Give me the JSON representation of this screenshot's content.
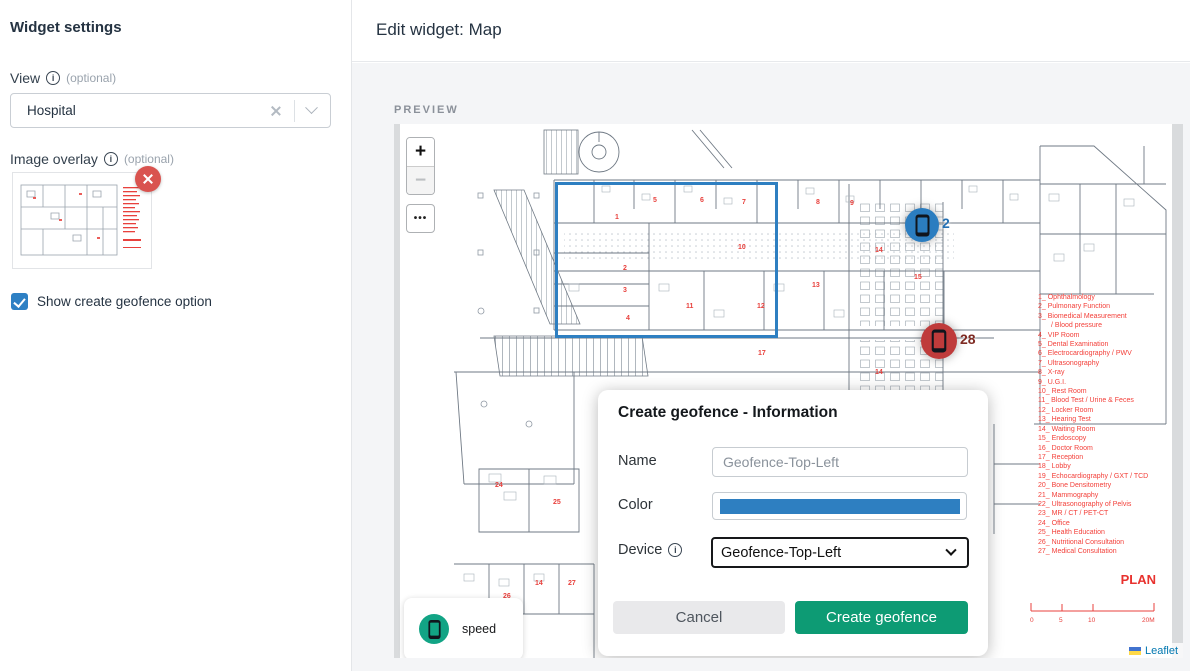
{
  "sidebar": {
    "title": "Widget settings",
    "view_label": "View",
    "view_optional": "(optional)",
    "view_value": "Hospital",
    "overlay_label": "Image overlay",
    "overlay_optional": "(optional)",
    "checkbox_label": "Show create geofence option"
  },
  "header": {
    "title": "Edit widget: Map"
  },
  "preview": {
    "label": "PREVIEW"
  },
  "map": {
    "controls": {
      "zoom_in": "+",
      "zoom_out": "−",
      "more": "•••"
    },
    "markers": [
      {
        "id": "blue",
        "count": "2",
        "color": "#2b7dc0",
        "label_color": "#2470b3"
      },
      {
        "id": "red",
        "count": "28",
        "color": "#bf3b3b",
        "label_color": "#7e2a22"
      }
    ],
    "speed_legend": "speed",
    "legend_title": "PLAN",
    "legend_items": [
      "1_ Ophthalmology",
      "2_ Pulmonary Function",
      "3_ Biomedical Measurement",
      "/ Blood pressure",
      "4_ VIP Room",
      "5_ Dental Examination",
      "6_ Electrocardiography / PWV",
      "7_ Ultrasonography",
      "8_ X-ray",
      "9_ U.G.I.",
      "10_ Rest Room",
      "11_ Blood Test / Urine & Feces",
      "12_ Locker Room",
      "13_ Hearing Test",
      "14_ Waiting Room",
      "15_ Endoscopy",
      "16_ Doctor Room",
      "17_ Reception",
      "18_ Lobby",
      "19_ Echocardiography / GXT / TCD",
      "20_ Bone Densitometry",
      "21_ Mammography",
      "22_ Ultrasonography of Pelvis",
      "23_ MR / CT / PET-CT",
      "24_ Office",
      "25_ Health Education",
      "26_ Nutritional Consultation",
      "27_ Medical Consultation"
    ],
    "scale": {
      "ticks": [
        "0",
        "5",
        "10",
        "20M"
      ]
    },
    "attribution": "Leaflet",
    "plan_numbers": [
      {
        "x": 221,
        "y": 95,
        "t": "1"
      },
      {
        "x": 229,
        "y": 146,
        "t": "2"
      },
      {
        "x": 229,
        "y": 168,
        "t": "3"
      },
      {
        "x": 232,
        "y": 196,
        "t": "4"
      },
      {
        "x": 259,
        "y": 78,
        "t": "5"
      },
      {
        "x": 306,
        "y": 78,
        "t": "6"
      },
      {
        "x": 348,
        "y": 80,
        "t": "7"
      },
      {
        "x": 422,
        "y": 80,
        "t": "8"
      },
      {
        "x": 456,
        "y": 81,
        "t": "9"
      },
      {
        "x": 344,
        "y": 125,
        "t": "10"
      },
      {
        "x": 292,
        "y": 184,
        "t": "11"
      },
      {
        "x": 363,
        "y": 184,
        "t": "12"
      },
      {
        "x": 418,
        "y": 163,
        "t": "13"
      },
      {
        "x": 481,
        "y": 128,
        "t": "14"
      },
      {
        "x": 520,
        "y": 155,
        "t": "15"
      },
      {
        "x": 481,
        "y": 250,
        "t": "14"
      },
      {
        "x": 364,
        "y": 231,
        "t": "17"
      },
      {
        "x": 101,
        "y": 363,
        "t": "24"
      },
      {
        "x": 159,
        "y": 380,
        "t": "25"
      },
      {
        "x": 109,
        "y": 474,
        "t": "26"
      },
      {
        "x": 141,
        "y": 461,
        "t": "14"
      },
      {
        "x": 174,
        "y": 461,
        "t": "27"
      }
    ]
  },
  "dialog": {
    "title": "Create geofence - Information",
    "name_label": "Name",
    "name_value": "Geofence-Top-Left",
    "color_label": "Color",
    "device_label": "Device",
    "device_value": "Geofence-Top-Left",
    "cancel": "Cancel",
    "submit": "Create geofence"
  },
  "colors": {
    "geofence": "#2e7fc1",
    "color_bar": "#2e7fc1",
    "checkbox": "#2e80c4",
    "remove_badge": "#d9534f",
    "submit_green": "#0d9b74",
    "speed_green": "#12a485",
    "flag_blue": "#4173cf",
    "flag_yellow": "#ffd948"
  }
}
